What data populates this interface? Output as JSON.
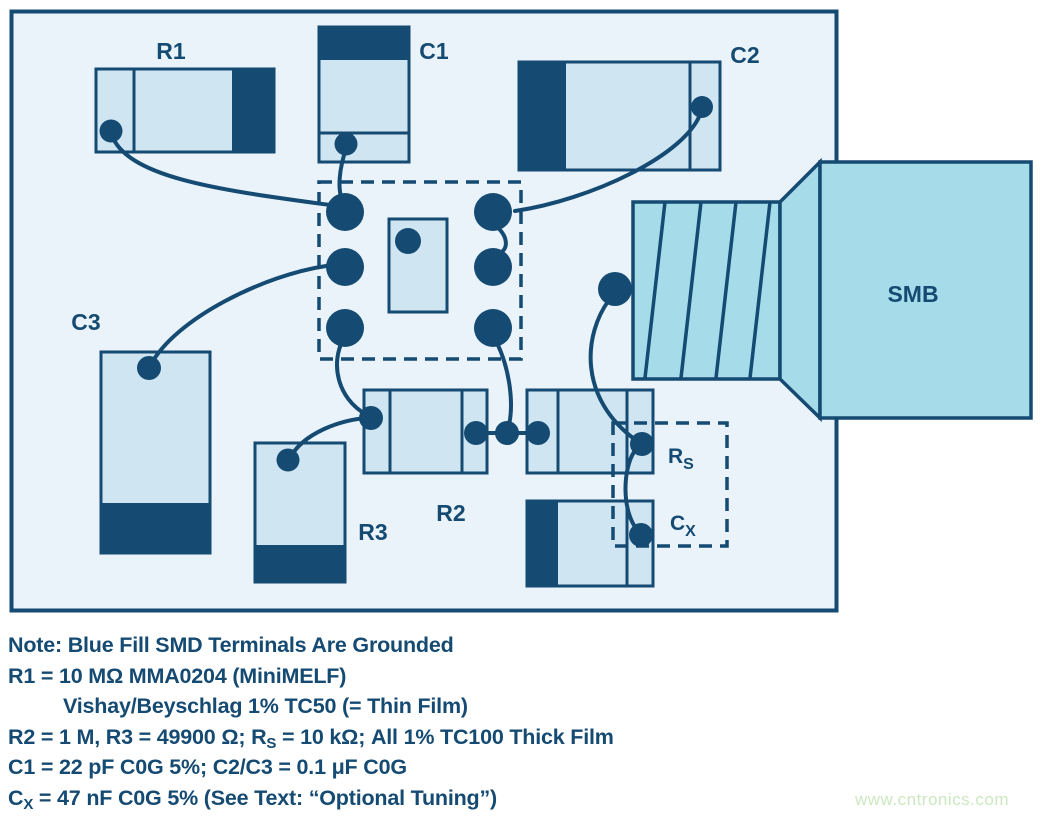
{
  "colors": {
    "dark_navy": "#154a72",
    "component_fill": "#cfe6f2",
    "board_background": "#e9f3f9",
    "connector_fill": "#a6dbea",
    "watermark_green": "#cbe8c0"
  },
  "components": {
    "r1": "R1",
    "c1": "C1",
    "c2": "C2",
    "c3": "C3",
    "r2": "R2",
    "r3": "R3",
    "smb": "SMB",
    "rs_main": "R",
    "rs_sub": "S",
    "cx_main": "C",
    "cx_sub": "X"
  },
  "notes": {
    "line1": "Note: Blue Fill SMD Terminals Are Grounded",
    "line2": "R1 = 10 MΩ MMA0204 (MiniMELF)",
    "line3": "Vishay/Beyschlag 1% TC50 (= Thin Film)",
    "line4_pre": "R2 = 1 M, R3 = 49900 Ω; R",
    "line4_sub": "S",
    "line4_post": " = 10 kΩ; All 1% TC100 Thick Film",
    "line5": "C1 = 22 pF C0G 5%; C2/C3 = 0.1 μF C0G",
    "line6_pre": "C",
    "line6_sub": "X",
    "line6_post": " = 47 nF C0G 5% (See Text: “Optional Tuning”)"
  },
  "watermark": "www.cntronics.com"
}
